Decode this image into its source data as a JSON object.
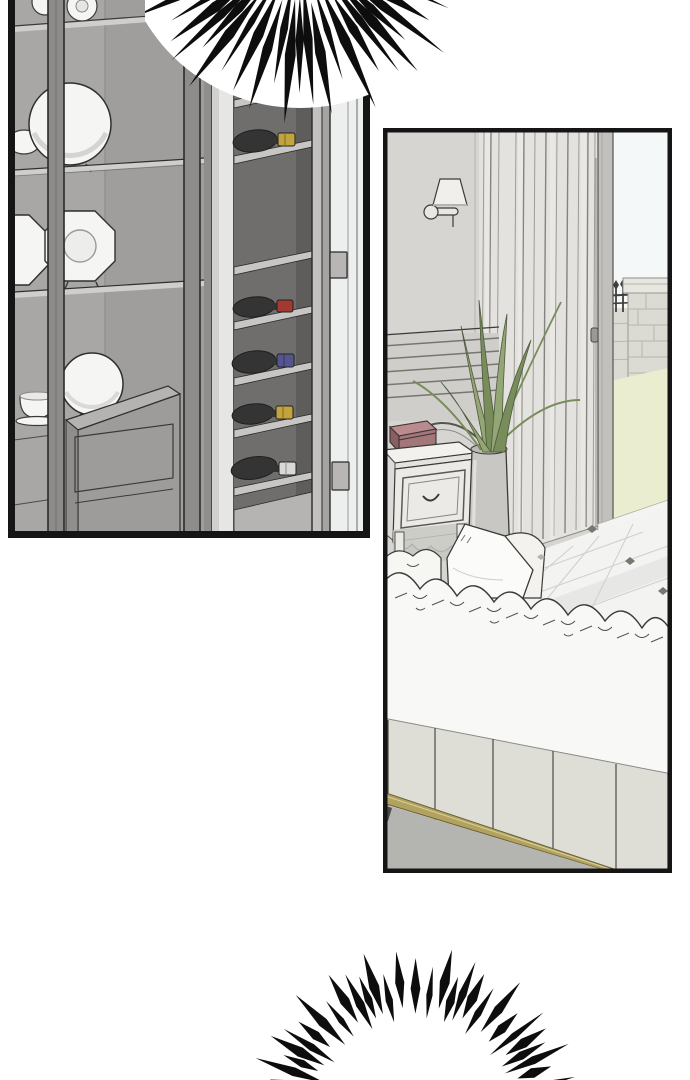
{
  "page": {
    "kind": "webtoon-comic-page",
    "background": "#ffffff",
    "panel_count": 2,
    "text_content": ""
  },
  "panels": [
    {
      "id": "panel-display-cabinet",
      "description": "glass display cabinet with plates, teacup and a tall dark wine cabinet with bottles, white door with hinges",
      "border_color": "#151515",
      "plates": {
        "round_plates": 3,
        "octagonal_plates": 2,
        "teacups": 2
      },
      "wine_rack": {
        "shelf_count": 7,
        "bottle_count": 6,
        "bottle_cap_colors_top_to_bottom": [
          "red",
          "yellow",
          "red",
          "blue",
          "yellow",
          "white"
        ]
      }
    },
    {
      "id": "panel-bedroom",
      "description": "bedroom corner with wall sconce, tall curtains, potted spiky plant on a white nightstand with a mauve box, white tufted sofa with pillows, gold trim base, and an open door to a terrace with iron fence, stone pillar and lawn",
      "border_color": "#151515"
    }
  ],
  "effects": [
    {
      "id": "burst-emphasis-top",
      "style": "black tapered speed-line burst radiating downward over panel top"
    },
    {
      "id": "burst-emphasis-bottom",
      "style": "black tapered speed-line arc radiating upward from below canvas"
    }
  ],
  "colors": {
    "ink": "#2e2e2c",
    "border-black": "#151515",
    "cabinet-bg": "#a8a7a5",
    "cabinet-bg-dark": "#9b9a98",
    "frame-bar": "#8d8c8a",
    "shelf-light": "#cfcecc",
    "plate-white": "#f5f5f3",
    "rack-interior": "#6f6e6c",
    "rack-interior-dark": "#5e5d5b",
    "rack-shelf": "#c7c6c4",
    "door-white": "#edeeee",
    "stile-light": "#e6e6e4",
    "hinge-grey": "#b7b6b4",
    "bottle-dark": "#343434",
    "bottle-grey": "#6e6d6b",
    "cap-red": "#a33a32",
    "cap-yellow": "#c2a33d",
    "cap-blue": "#55548f",
    "cap-white": "#d8d8d6",
    "wall-grey": "#d6d5d1",
    "curtain": "#e3e2de",
    "sky": "#f5f8f8",
    "grass": "#eaedd0",
    "stone": "#dcdbd3",
    "fence-dark": "#3f3f3d",
    "plant-green": "#94a576",
    "plant-green-dark": "#788c5c",
    "vase-grey": "#c8c7c3",
    "box-top": "#ba8b8e",
    "box-front": "#a3767a",
    "box-side": "#8a5f62",
    "furniture-white": "#f1f0ec",
    "couch-white": "#f8f8f6",
    "couch-base": "#deddd6",
    "gold-trim": "#b2a25f",
    "carpet-grey": "#b4b5b1",
    "tile-white": "#f3f3f1",
    "tile-shade": "#e6e6e4",
    "burst-black": "#0d0d0d"
  }
}
